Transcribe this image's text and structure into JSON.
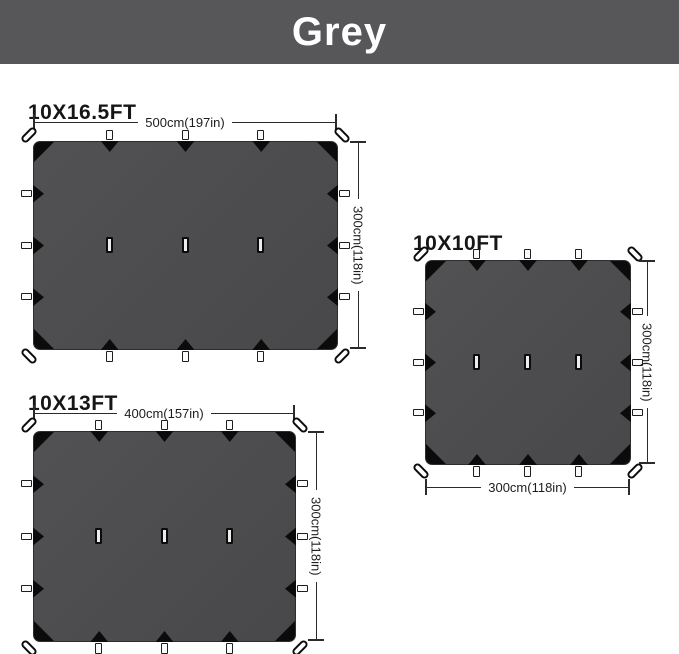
{
  "banner": {
    "label": "Grey",
    "background_color": "#57575A",
    "text_color": "#FFFFFF"
  },
  "colors": {
    "tarp_fill": "#4C4C4E",
    "tarp_edge": "#2E2E30",
    "tie_black": "#0B0B0B",
    "dim_line": "#2B2B2B",
    "page_background": "#FFFFFF"
  },
  "tarps": [
    {
      "title": "10X16.5FT",
      "width_label": "500cm(197in)",
      "height_label": "300cm(118in)"
    },
    {
      "title": "10X10FT",
      "width_label": "300cm(118in)",
      "height_label": "300cm(118in)"
    },
    {
      "title": "10X13FT",
      "width_label": "400cm(157in)",
      "height_label": "300cm(118in)"
    }
  ]
}
